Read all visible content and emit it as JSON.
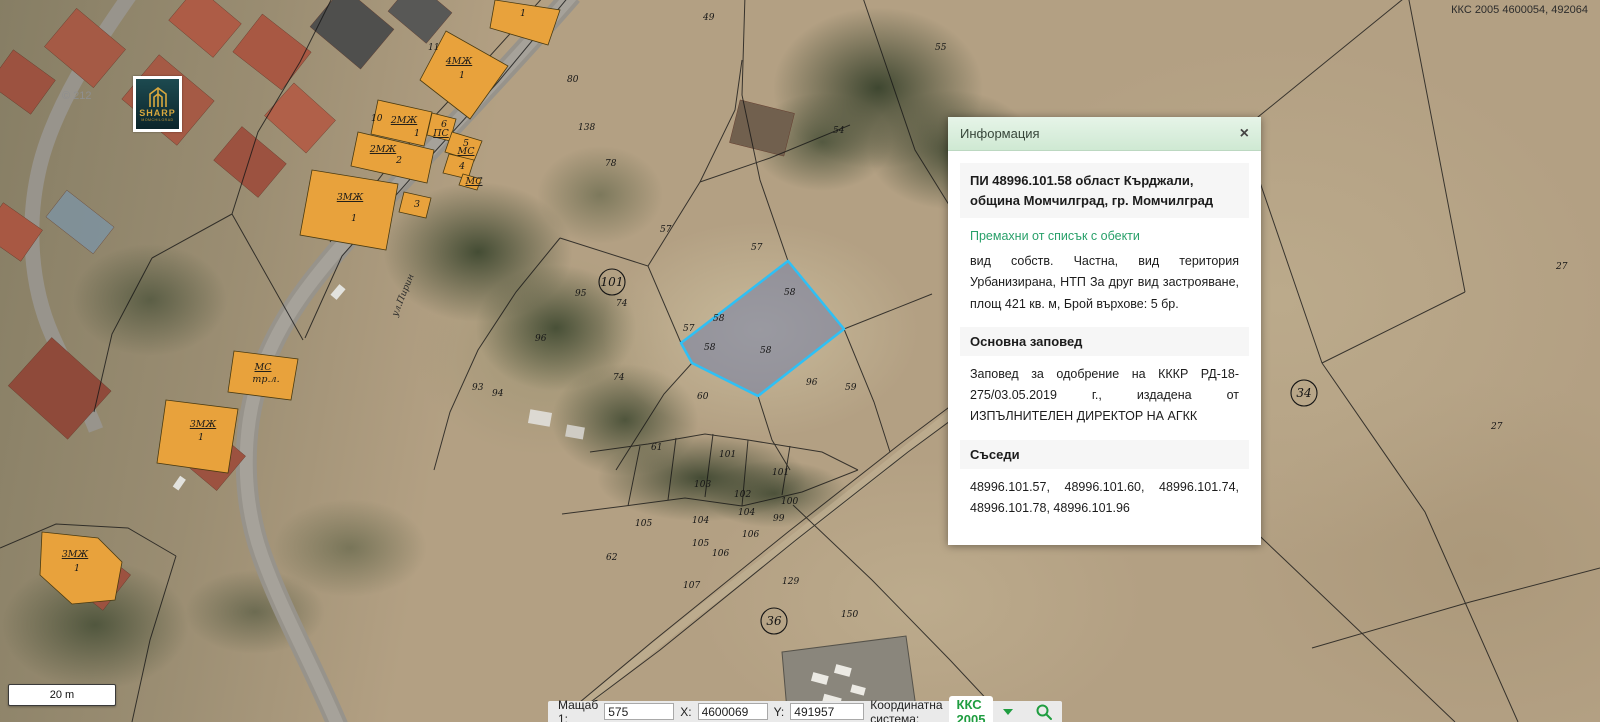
{
  "header": {
    "coordinate_readout": "ККС 2005 4600054, 492064"
  },
  "logo": {
    "brand": "SHARP",
    "city": "MOMCHILGRAD"
  },
  "watermark": "© 212",
  "scale_bar": {
    "label": "20 m"
  },
  "status_bar": {
    "scale_label": "Мащаб 1:",
    "scale_value": "575",
    "x_label": "X:",
    "x_value": "4600069",
    "y_label": "Y:",
    "y_value": "491957",
    "crs_label": "Координатна система:",
    "crs_value": "ККС 2005"
  },
  "info_panel": {
    "title": "Информация",
    "close_glyph": "×",
    "object_title": "ПИ 48996.101.58 област Кърджали, община Момчилград, гр. Момчилград",
    "remove_link": "Премахни от списък с обекти",
    "details": "вид собств. Частна, вид територия Урбанизирана, НТП За друг вид застрояване, площ 421 кв. м, Брой върхове: 5 бр.",
    "sections": [
      {
        "heading": "Основна заповед",
        "text": "Заповед за одобрение на КККР РД-18-275/03.05.2019 г., издадена от ИЗПЪЛНИТЕЛЕН ДИРЕКТОР НА АГКК"
      },
      {
        "heading": "Съседи",
        "text": "48996.101.57, 48996.101.60, 48996.101.74, 48996.101.78, 48996.101.96"
      }
    ]
  },
  "map": {
    "selected_parcel_id": "58",
    "colors": {
      "building_fill": "#e8a23c",
      "selection_stroke": "#2ec0f5",
      "selection_fill": "rgba(108,122,168,0.5)",
      "crs_green": "#1f9d40",
      "panel_header_green": "#d9edda"
    },
    "road_label": {
      "t": "ул.Пирин",
      "x": 397,
      "y": 317,
      "rot": -68
    },
    "circled_labels": [
      {
        "t": "101",
        "x": 612,
        "y": 286
      },
      {
        "t": "36",
        "x": 774,
        "y": 625
      },
      {
        "t": "34",
        "x": 1304,
        "y": 397
      }
    ],
    "parcel_numbers": [
      {
        "t": "49",
        "x": 703,
        "y": 20
      },
      {
        "t": "55",
        "x": 935,
        "y": 50
      },
      {
        "t": "80",
        "x": 567,
        "y": 82
      },
      {
        "t": "11",
        "x": 428,
        "y": 50
      },
      {
        "t": "10",
        "x": 371,
        "y": 121
      },
      {
        "t": "138",
        "x": 578,
        "y": 130
      },
      {
        "t": "54",
        "x": 833,
        "y": 133
      },
      {
        "t": "78",
        "x": 605,
        "y": 166
      },
      {
        "t": "57",
        "x": 660,
        "y": 232
      },
      {
        "t": "57",
        "x": 751,
        "y": 250
      },
      {
        "t": "74",
        "x": 616,
        "y": 306
      },
      {
        "t": "95",
        "x": 575,
        "y": 296
      },
      {
        "t": "96",
        "x": 535,
        "y": 341
      },
      {
        "t": "74",
        "x": 613,
        "y": 380
      },
      {
        "t": "93",
        "x": 472,
        "y": 390
      },
      {
        "t": "94",
        "x": 492,
        "y": 396
      },
      {
        "t": "57",
        "x": 683,
        "y": 331
      },
      {
        "t": "58",
        "x": 784,
        "y": 295
      },
      {
        "t": "58",
        "x": 713,
        "y": 321
      },
      {
        "t": "58",
        "x": 704,
        "y": 350
      },
      {
        "t": "58",
        "x": 760,
        "y": 353
      },
      {
        "t": "96",
        "x": 806,
        "y": 385
      },
      {
        "t": "59",
        "x": 845,
        "y": 390
      },
      {
        "t": "60",
        "x": 697,
        "y": 399
      },
      {
        "t": "61",
        "x": 651,
        "y": 450
      },
      {
        "t": "101",
        "x": 719,
        "y": 457
      },
      {
        "t": "101",
        "x": 772,
        "y": 475
      },
      {
        "t": "103",
        "x": 694,
        "y": 487
      },
      {
        "t": "102",
        "x": 734,
        "y": 497
      },
      {
        "t": "100",
        "x": 781,
        "y": 504
      },
      {
        "t": "104",
        "x": 738,
        "y": 515
      },
      {
        "t": "104",
        "x": 692,
        "y": 523
      },
      {
        "t": "105",
        "x": 635,
        "y": 526
      },
      {
        "t": "99",
        "x": 773,
        "y": 521
      },
      {
        "t": "106",
        "x": 742,
        "y": 537
      },
      {
        "t": "105",
        "x": 692,
        "y": 546
      },
      {
        "t": "106",
        "x": 712,
        "y": 556
      },
      {
        "t": "62",
        "x": 606,
        "y": 560
      },
      {
        "t": "107",
        "x": 683,
        "y": 588
      },
      {
        "t": "129",
        "x": 782,
        "y": 584
      },
      {
        "t": "150",
        "x": 841,
        "y": 617
      },
      {
        "t": "27",
        "x": 1556,
        "y": 269
      },
      {
        "t": "27",
        "x": 1491,
        "y": 429
      }
    ],
    "building_labels": [
      {
        "t": "1",
        "x": 523,
        "y": 16
      },
      {
        "t": "4МЖ",
        "x": 459,
        "y": 64,
        "u": 1
      },
      {
        "t": "1",
        "x": 462,
        "y": 78
      },
      {
        "t": "2МЖ",
        "x": 404,
        "y": 123,
        "u": 1
      },
      {
        "t": "1",
        "x": 417,
        "y": 136
      },
      {
        "t": "2МЖ",
        "x": 383,
        "y": 152,
        "u": 1
      },
      {
        "t": "2",
        "x": 399,
        "y": 163
      },
      {
        "t": "6",
        "x": 444,
        "y": 127
      },
      {
        "t": "ПС",
        "x": 441,
        "y": 136,
        "u": 1
      },
      {
        "t": "5",
        "x": 466,
        "y": 146
      },
      {
        "t": "МС",
        "x": 466,
        "y": 154,
        "u": 1
      },
      {
        "t": "4",
        "x": 462,
        "y": 169
      },
      {
        "t": "МС",
        "x": 474,
        "y": 184,
        "u": 1
      },
      {
        "t": "3МЖ",
        "x": 350,
        "y": 200,
        "u": 1
      },
      {
        "t": "1",
        "x": 354,
        "y": 221
      },
      {
        "t": "3",
        "x": 417,
        "y": 207
      },
      {
        "t": "МС",
        "x": 263,
        "y": 370,
        "u": 1
      },
      {
        "t": "тр.л.",
        "x": 266,
        "y": 382
      },
      {
        "t": "3МЖ",
        "x": 203,
        "y": 427,
        "u": 1
      },
      {
        "t": "1",
        "x": 201,
        "y": 440
      },
      {
        "t": "3МЖ",
        "x": 75,
        "y": 557,
        "u": 1
      },
      {
        "t": "1",
        "x": 77,
        "y": 571
      }
    ]
  }
}
